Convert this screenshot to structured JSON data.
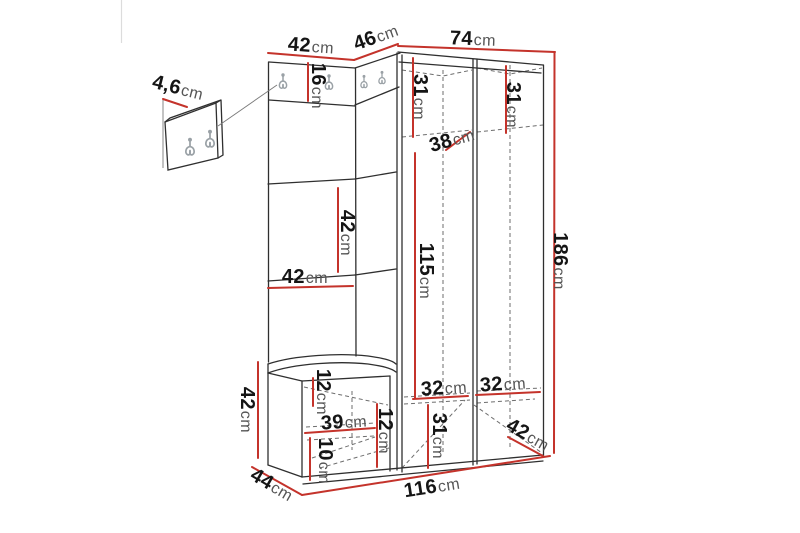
{
  "unit_suffix": "cm",
  "diagram_type": "furniture-dimension-drawing",
  "colors": {
    "dimension_line": "#c4332b",
    "outline": "#2f2f2f",
    "hidden_edge": "#6e6e6e",
    "hook": "#9aa1a6",
    "background": "#ffffff"
  },
  "dims": {
    "wall_panel_depth": "4,6",
    "top_width_left": "42",
    "top_width_corner": "46",
    "top_width_right": "74",
    "hook_rail_height": "16",
    "upper_compartment_left_height": "31",
    "upper_compartment_right_height": "31",
    "upper_shelf_depth": "38",
    "hanging_space_height": "115",
    "panel_segment_height": "42",
    "panel_width": "42",
    "total_height": "186",
    "bench_height": "42",
    "bench_top_rail_height": "12",
    "bench_shelf_width": "39",
    "bench_compartment_height": "12",
    "bench_bottom_clearance": "10",
    "bench_depth": "44",
    "total_width": "116",
    "lower_shelf_left_height": "32",
    "lower_shelf_right_height": "32",
    "lower_compartment_height": "31",
    "wardrobe_side_depth": "42"
  }
}
